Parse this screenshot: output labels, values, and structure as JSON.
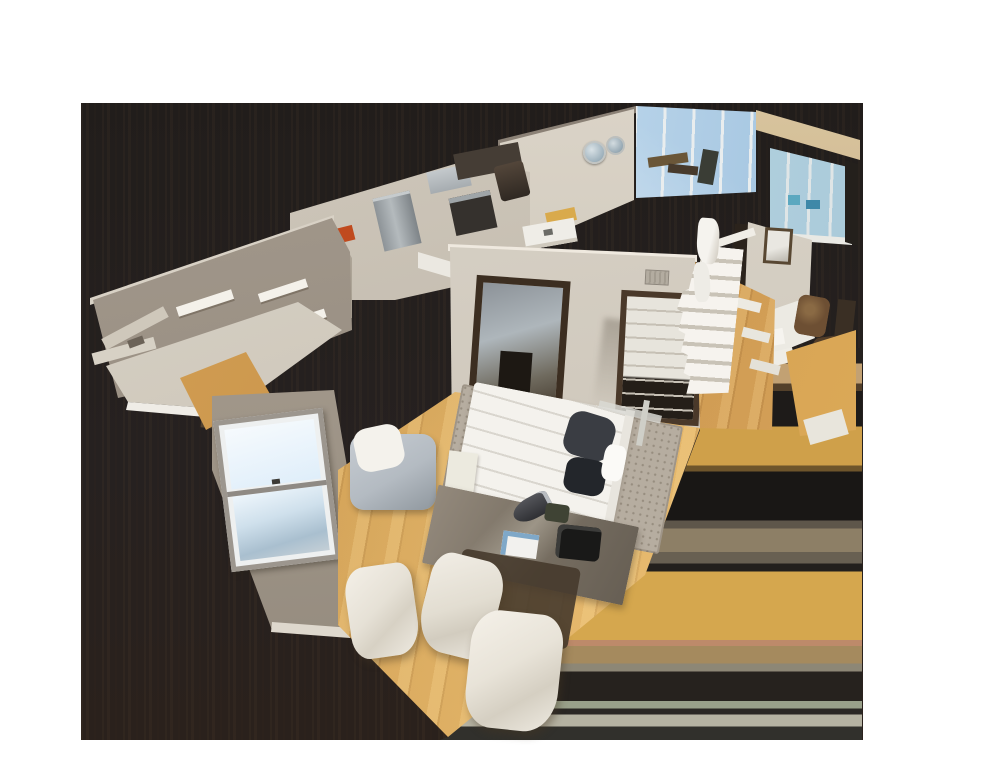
{
  "image": {
    "kind": "3d-dollhouse-scan",
    "description": "Cutaway dollhouse view of a 3D-scanned apartment floating over a dark streaked backdrop on a white page"
  },
  "palette": {
    "backdrop": "#211d1b",
    "backdrop_warm": "#2a211c",
    "smear_gold": "#d5a74e",
    "smear_tan": "#c2a173",
    "smear_salmon": "#bd8a6a",
    "smear_sage": "#99a08a",
    "wall_light": "#dcd6cb",
    "wall_mid": "#a89e91",
    "wall_grey": "#a1978a",
    "floor_wood": "#cf9d52",
    "floor_wood_light": "#e2b264",
    "rug": "#b6ada0",
    "bed_linen": "#f4f2ed",
    "pillow_dark": "#3a3d43",
    "window_sky": "#cfe4f4",
    "window_sky_deep": "#8fb2d0",
    "glass_teal": "#bcd8e4",
    "beam_tan": "#cbb28a",
    "door_frame": "#3c2e21",
    "stainless": "#b4babd",
    "accent_orange": "#c04a1e",
    "chair_white": "#e8e3d8",
    "desk_grey": "#7b7265",
    "stair_white": "#f6f3ee"
  },
  "elements": [
    {
      "id": "coat-hook-wall",
      "label": "hall wall with white coat hooks"
    },
    {
      "id": "console-shelf",
      "label": "light console shelf"
    },
    {
      "id": "bedroom-window",
      "label": "double-hung window with sky"
    },
    {
      "id": "bed",
      "label": "white bed with dark pillows"
    },
    {
      "id": "area-rug",
      "label": "speckled grey rug"
    },
    {
      "id": "armchair",
      "label": "grey armchair with white throw"
    },
    {
      "id": "desk",
      "label": "desk with book and camera bag"
    },
    {
      "id": "white-chairs",
      "label": "white dining chairs"
    },
    {
      "id": "mirror-door",
      "label": "mirrored closet door"
    },
    {
      "id": "closet-doorway",
      "label": "open closet doorway"
    },
    {
      "id": "staircase",
      "label": "white staircase"
    },
    {
      "id": "kitchen",
      "label": "stainless appliances and counters"
    },
    {
      "id": "orange-art",
      "label": "orange accent panel"
    },
    {
      "id": "wall-mirrors",
      "label": "round wall mirrors"
    },
    {
      "id": "window-band",
      "label": "floor-to-ceiling windows with sky"
    },
    {
      "id": "wood-beam",
      "label": "tan beam over glass wall"
    },
    {
      "id": "picture-frame",
      "label": "framed picture on wall"
    },
    {
      "id": "wood-floor",
      "label": "golden wood flooring"
    }
  ]
}
